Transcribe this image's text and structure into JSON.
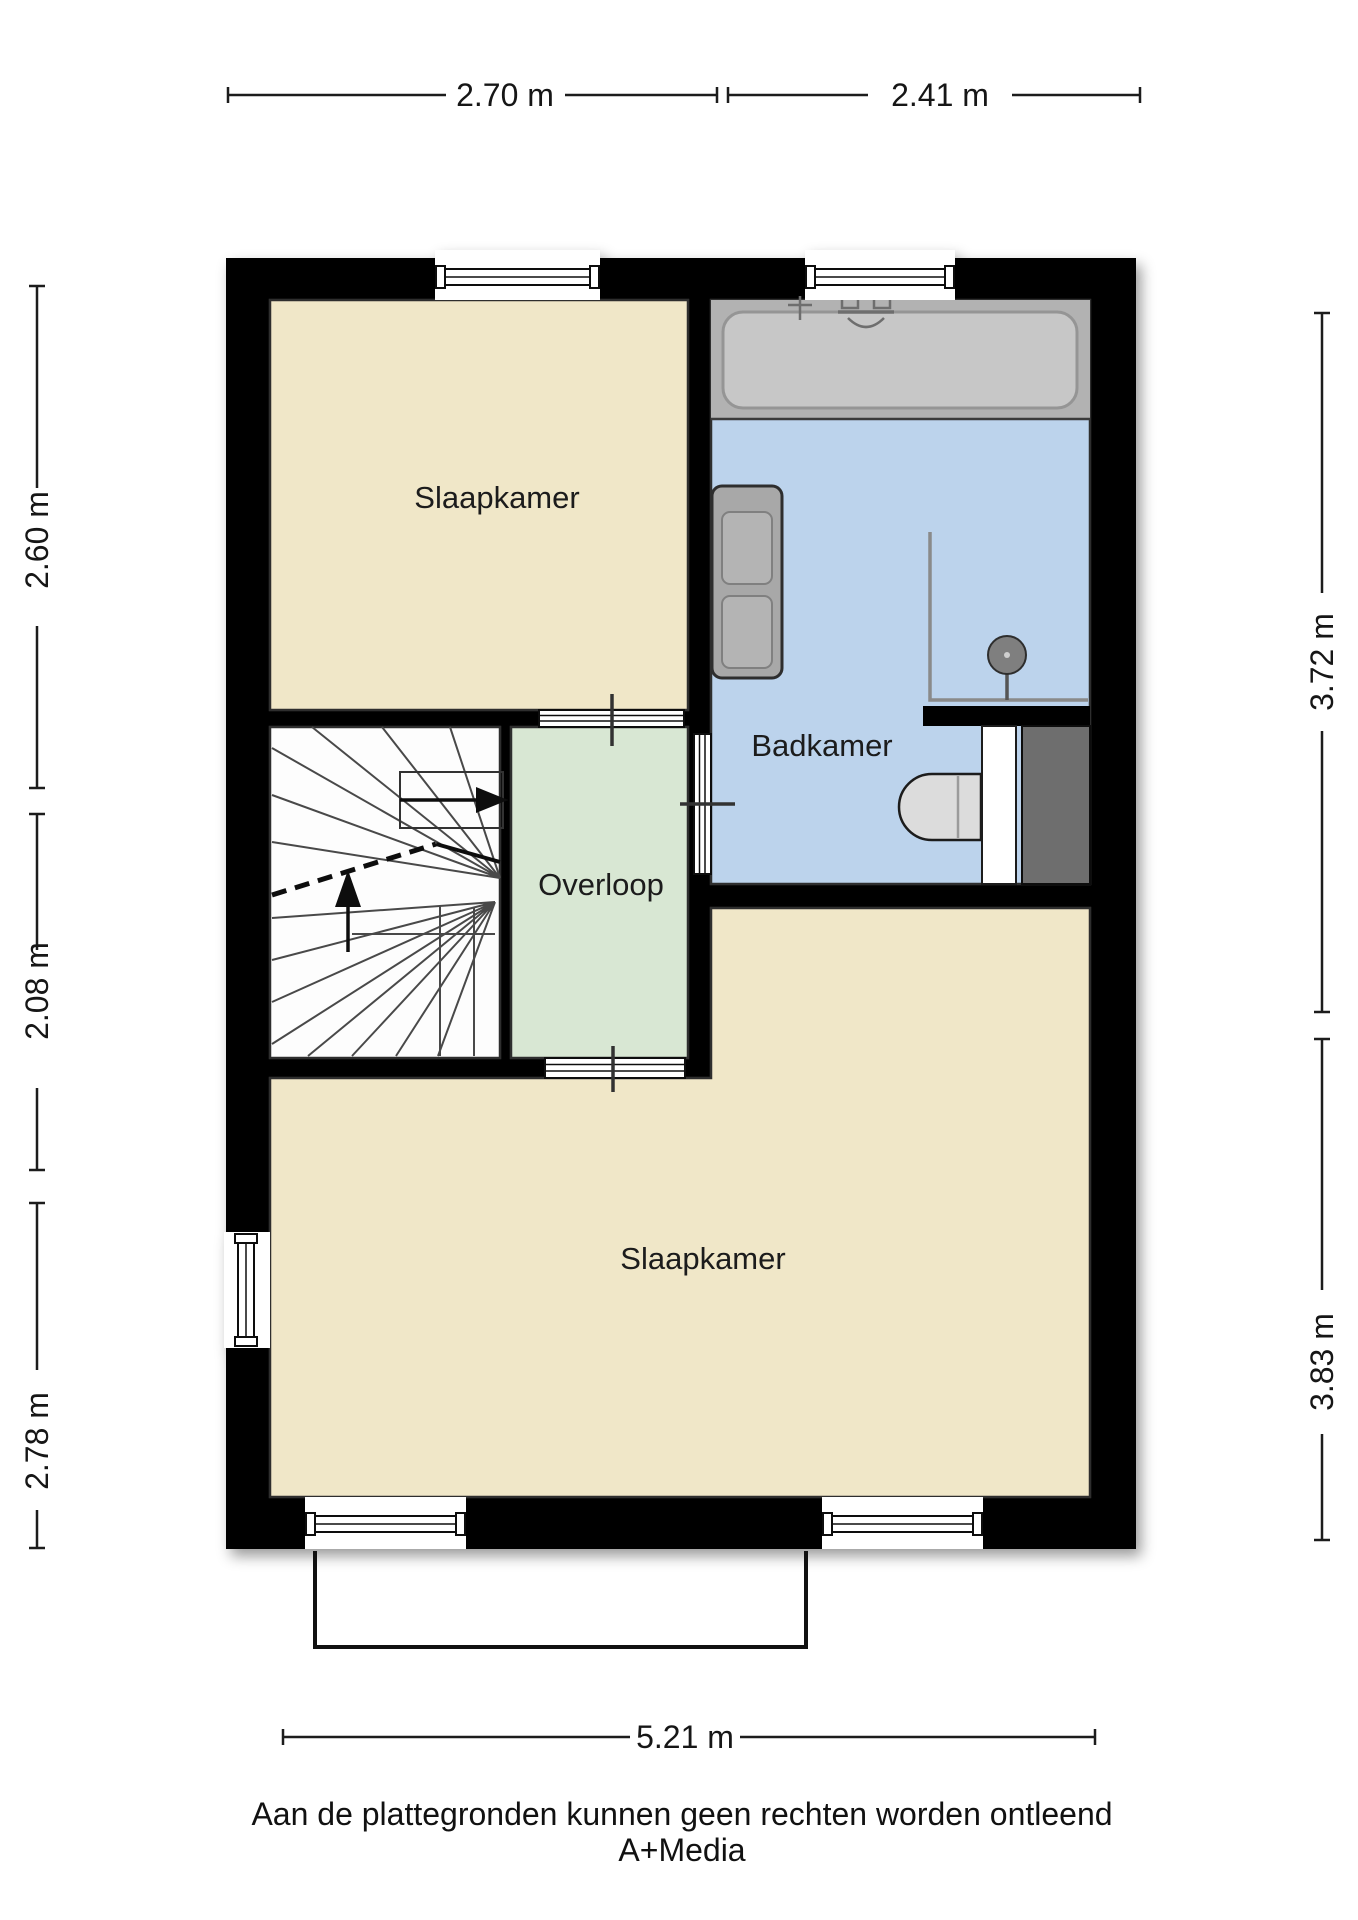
{
  "floorplan": {
    "rooms": {
      "bedroom_top": {
        "label": "Slaapkamer"
      },
      "bathroom": {
        "label": "Badkamer"
      },
      "landing": {
        "label": "Overloop"
      },
      "bedroom_bottom": {
        "label": "Slaapkamer"
      }
    },
    "fixtures": [
      "bathtub",
      "washbasin",
      "shower",
      "toilet",
      "stairs",
      "terrace-outline"
    ],
    "colors": {
      "wall": "#060606",
      "bedroom": "#F0E7C8",
      "bathroom": "#BCD3EC",
      "landing": "#D8E7D3",
      "stairwell": "#FDFDFD",
      "tub": "#B2B2B2",
      "tub_inner": "#C7C7C7",
      "vanity": "#A8A8A8",
      "basin": "#B4B4B4",
      "dark_unit": "#6E6E6E",
      "toilet": "#DCDCDC"
    }
  },
  "dimensions": {
    "top": [
      {
        "label": "2.70 m"
      },
      {
        "label": "2.41 m"
      }
    ],
    "left": [
      {
        "label": "2.60 m"
      },
      {
        "label": "2.08 m"
      },
      {
        "label": "2.78 m"
      }
    ],
    "right": [
      {
        "label": "3.72 m"
      },
      {
        "label": "3.83 m"
      }
    ],
    "bottom": [
      {
        "label": "5.21 m"
      }
    ]
  },
  "footer": {
    "disclaimer": "Aan de plattegronden kunnen geen rechten worden ontleend",
    "credit": "A+Media"
  }
}
